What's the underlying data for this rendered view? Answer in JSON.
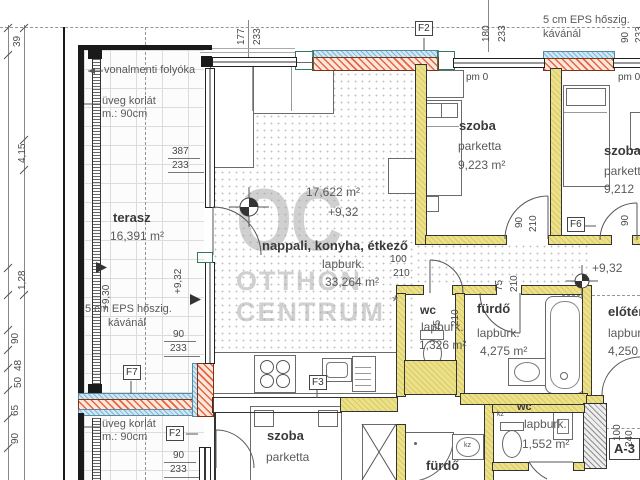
{
  "watermark": {
    "logo": "OC",
    "line1": "OTTHON",
    "line2": "CENTRUM"
  },
  "rooms": {
    "terasz": {
      "name": "terasz",
      "area": "16,391 m²"
    },
    "nappali": {
      "name": "nappali, konyha, étkező",
      "floor": "lapburk.",
      "area": "33,264 m²",
      "area_calc": "17,622 m²",
      "level": "+9,32"
    },
    "szoba1": {
      "name": "szoba",
      "floor": "parketta",
      "area": "9,223 m²"
    },
    "szoba2": {
      "name": "szoba",
      "floor": "parketta",
      "area": "9,212"
    },
    "wc": {
      "name": "wc",
      "floor": "lapburk.",
      "area": "1,326 m²"
    },
    "furdo": {
      "name": "fürdő",
      "floor": "lapburk.",
      "area": "4,275 m²"
    },
    "eloter": {
      "name": "előtér",
      "floor": "lapburk.",
      "area": "4,250"
    },
    "szoba3": {
      "name": "szoba",
      "floor": "parketta"
    },
    "furdo2": {
      "name": "fürdő"
    },
    "wc2": {
      "name": "wc",
      "floor": "lapburk.",
      "area": "1,552 m²"
    }
  },
  "levels": {
    "t930": "+9,30",
    "t932": "+9,32",
    "hall": "+9,32",
    "pm_left": "pm 0",
    "pm_right": "pm 0"
  },
  "notes": {
    "vonalmenti": "vonalmenti folyóka",
    "uveg1a": "üveg korlát",
    "uveg1b": "m.: 90cm",
    "uveg2a": "üveg korlát",
    "uveg2b": "m.: 90cm",
    "eps1a": "5 cm EPS hőszig.",
    "eps1b": "kávánál",
    "eps2a": "5 cm EPS hőszig.",
    "eps2b": "kávánál",
    "asterisk": "*",
    "kz1": "kz",
    "kz2": "kz"
  },
  "tags": {
    "f2_top": "F2",
    "f2_bottom": "F2",
    "f3": "F3",
    "f6": "F6",
    "f7": "F7",
    "unit": "A-3"
  },
  "dims": {
    "left_chain": [
      "39",
      "4,15",
      "1,28",
      "90",
      "48",
      "50",
      "65",
      "90"
    ],
    "top": {
      "a": "177",
      "b": "233",
      "c": "180",
      "d": "233",
      "e": "90",
      "f": "233"
    },
    "glazing": {
      "w": "387",
      "h": "233"
    },
    "terrace_mid": {
      "w": "90",
      "h": "233"
    },
    "terrace_bot": {
      "w": "90",
      "h": "233"
    },
    "door_szoba1": {
      "w": "90",
      "h": "210"
    },
    "door_szoba2": {
      "w": "90"
    },
    "door_wc": {
      "w": "75",
      "h": "210"
    },
    "door_furdo": {
      "w": "75",
      "h": "210"
    },
    "door_nappali": {
      "w": "100",
      "h": "210"
    },
    "bottom_right": {
      "w": "100",
      "h": "240"
    }
  }
}
